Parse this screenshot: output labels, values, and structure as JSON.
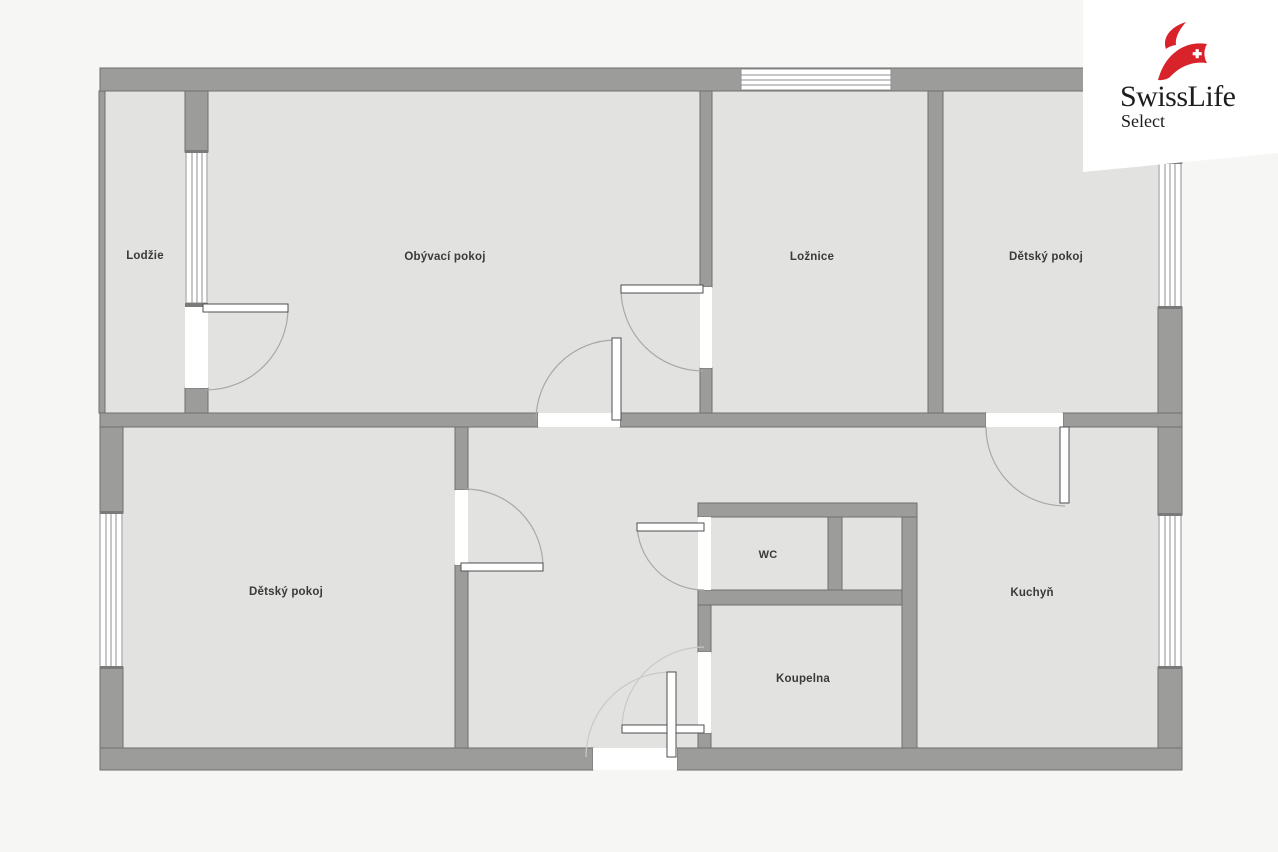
{
  "title": "Floor plan",
  "logo": {
    "brand": "SwissLife",
    "sub": "Select",
    "red": "#d8232a",
    "text_color": "#1d1d1b"
  },
  "rooms": {
    "lodzie": {
      "label": "Lodžie"
    },
    "obyvaci": {
      "label": "Obývací pokoj"
    },
    "loznice": {
      "label": "Ložnice"
    },
    "detsky_horni": {
      "label": "Dětský pokoj"
    },
    "detsky_dolni": {
      "label": "Dětský pokoj"
    },
    "wc": {
      "label": "WC"
    },
    "koupelna": {
      "label": "Koupelna"
    },
    "kuchyn": {
      "label": "Kuchyň"
    }
  },
  "colors": {
    "wall": "#9c9c9b",
    "wall-line": "#6f6f6f",
    "floor": "#e2e2e1",
    "bg": "#f6f6f5",
    "white": "#ffffff",
    "arc": "#a8a8a8",
    "arc-faint": "#c9c9c9",
    "leaf-line": "#4f4f4f",
    "win-line": "#8f8f8f",
    "sill": "#7a7a7a",
    "label": "#3a3a3a",
    "logo-red": "#d8232a",
    "logo-text": "#1d1d1b"
  }
}
